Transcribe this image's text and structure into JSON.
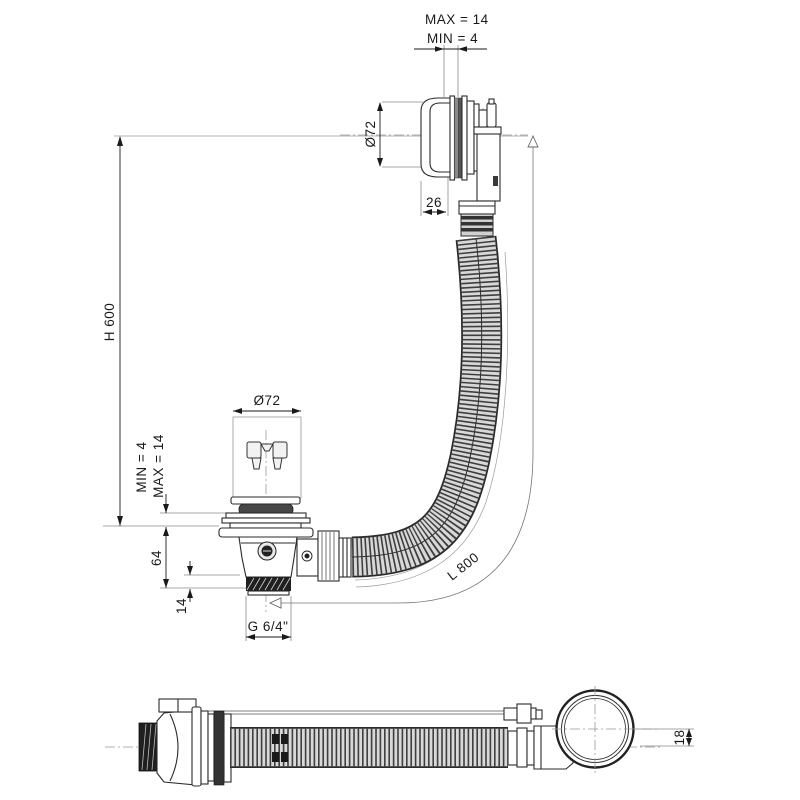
{
  "drawing": {
    "kind": "bath-waste-overflow-technical-drawing",
    "labels": {
      "top_max": "MAX = 14",
      "top_min": "MIN = 4",
      "top_diameter": "Ø72",
      "cap_depth": "26",
      "height": "H 600",
      "hose_length": "L 800",
      "drain_diameter": "Ø72",
      "drain_min": "MIN = 4",
      "drain_max": "MAX = 14",
      "drain_depth": "64",
      "thread_length": "14",
      "thread_size": "G 6/4\"",
      "side_offset": "18"
    },
    "colors": {
      "background": "#ffffff",
      "line": "#2b2b2b",
      "thin_line": "#9a9a9a",
      "hose_fill": "#d8d8d8",
      "hose_stripe": "#3f3f3f",
      "thread_fill": "#1f1f1f",
      "seal_fill": "#474747"
    }
  }
}
